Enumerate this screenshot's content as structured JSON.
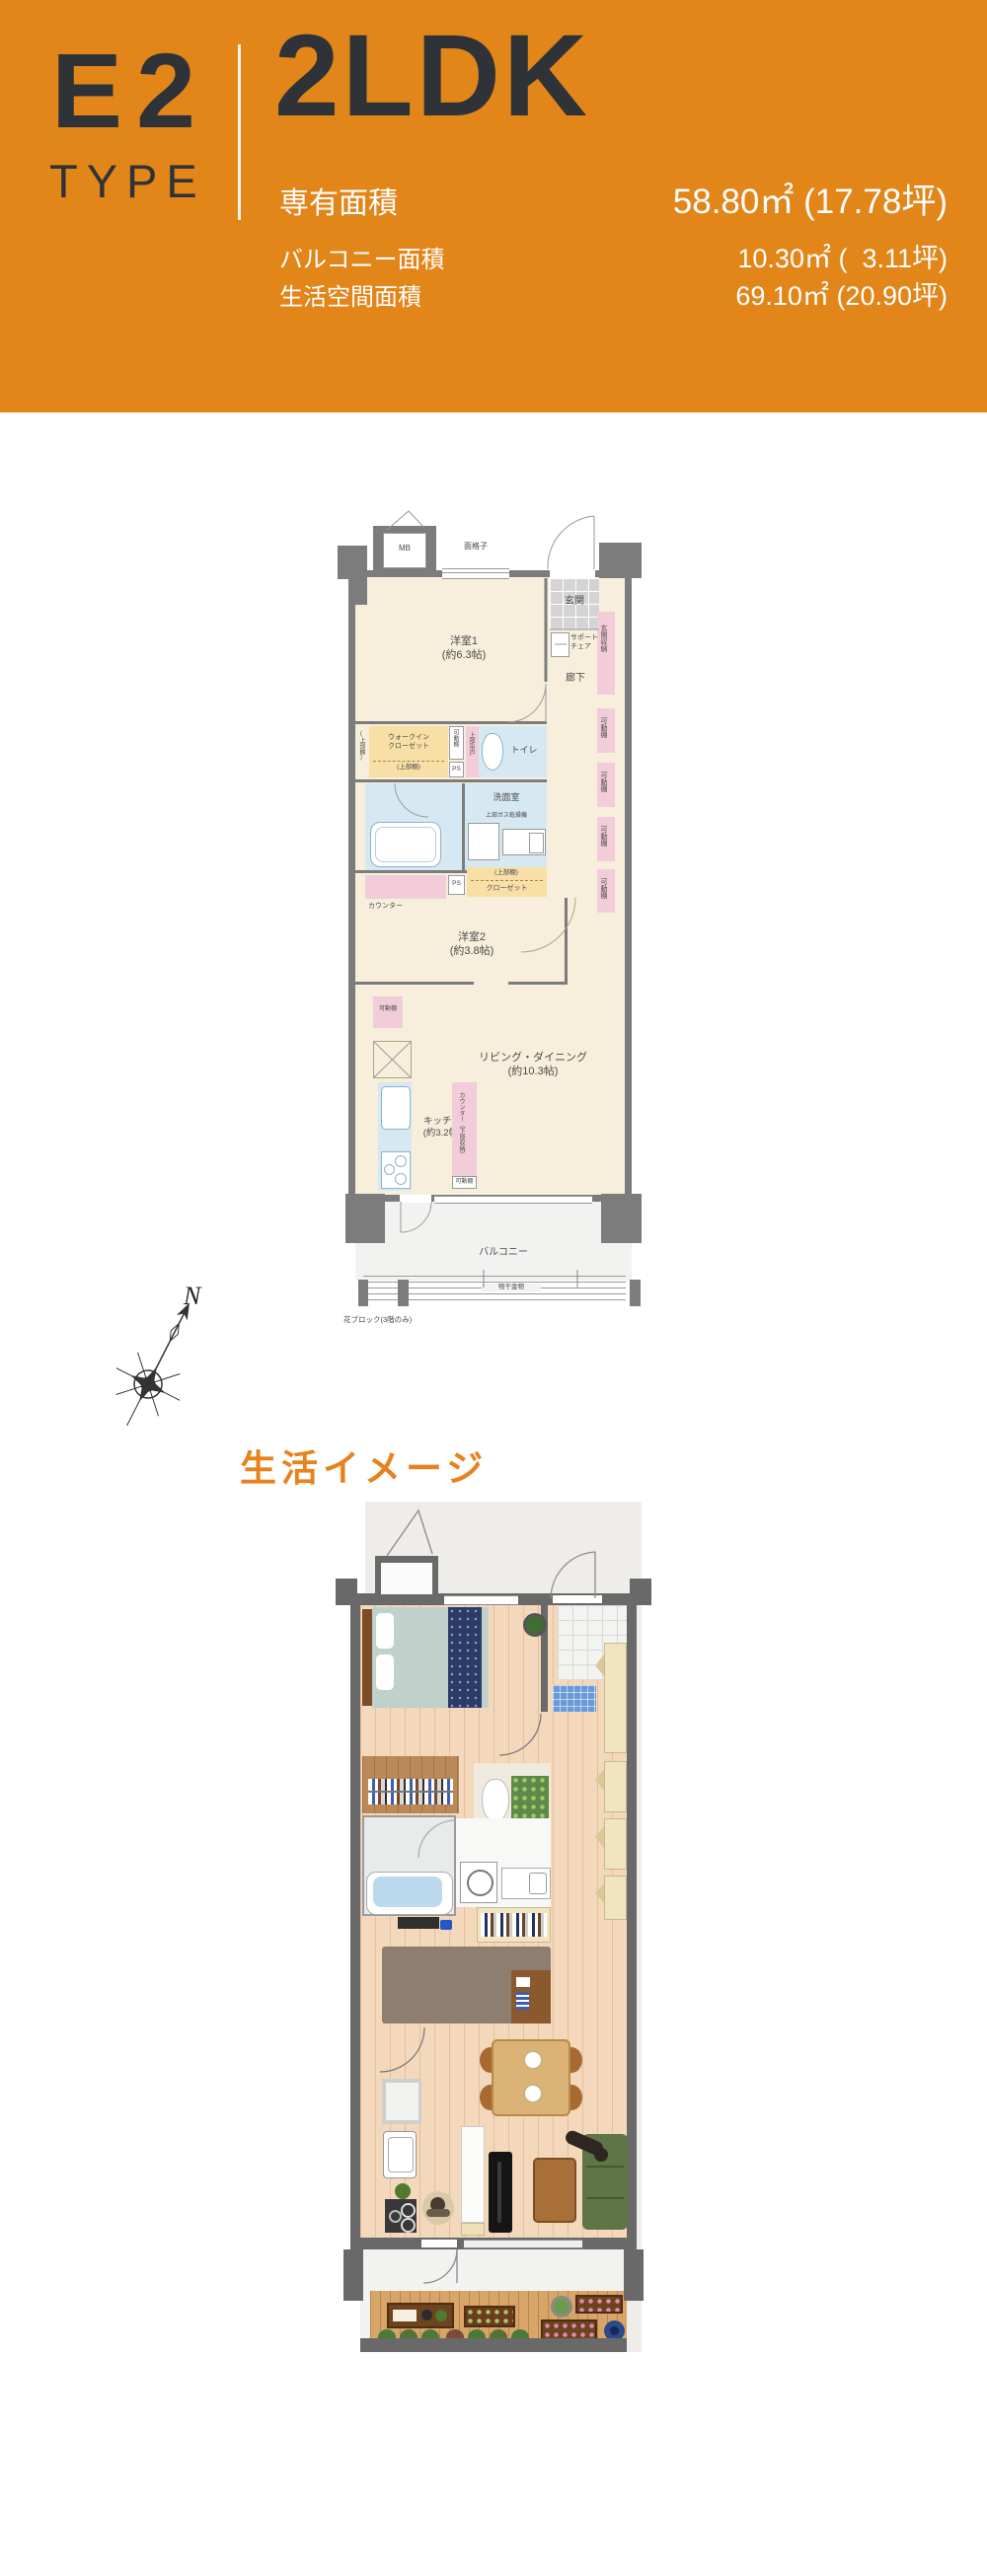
{
  "header": {
    "type_code": "E2",
    "type_word": "TYPE",
    "layout": "2LDK",
    "area_rows": [
      {
        "label": "専有面積",
        "value": "58.80㎡ (17.78坪)"
      },
      {
        "label": "バルコニー面積",
        "value": "10.30㎡ (  3.11坪)"
      },
      {
        "label": "生活空間面積",
        "value": "69.10㎡ (20.90坪)"
      }
    ],
    "colors": {
      "background": "#e2861a",
      "heading_text": "#2f3337",
      "detail_text": "#ffffff"
    }
  },
  "compass": {
    "north_label": "N"
  },
  "section": {
    "title": "生活イメージ",
    "color": "#e8821e"
  },
  "plan1": {
    "mb": "MB",
    "grille": "面格子",
    "entrance": "玄関",
    "support_chair": "サポート\nチェア",
    "entrance_storage": "玄関収納",
    "movable_shelf": "可動棚",
    "room1": "洋室1\n(約6.3帖)",
    "hallway": "廊下",
    "wic": "ウォークイン\nクローゼット",
    "upper_shelf": "(上部棚)",
    "ps": "PS",
    "upper_hanging": "上部吊戸",
    "toilet": "トイレ",
    "washroom": "洗面室",
    "gas_dryer": "上部ガス乾燥機",
    "closet": "クローゼット",
    "counter": "カウンター",
    "room2": "洋室2\n(約3.8帖)",
    "living": "リビング・ダイニング\n(約10.3帖)",
    "kitchen": "キッチン\n(約3.2帖)",
    "counter_storage": "カウンター（下部収納）",
    "balcony": "バルコニー",
    "laundry_hw": "物干金物",
    "flower_block": "花ブロック(3階のみ)"
  }
}
